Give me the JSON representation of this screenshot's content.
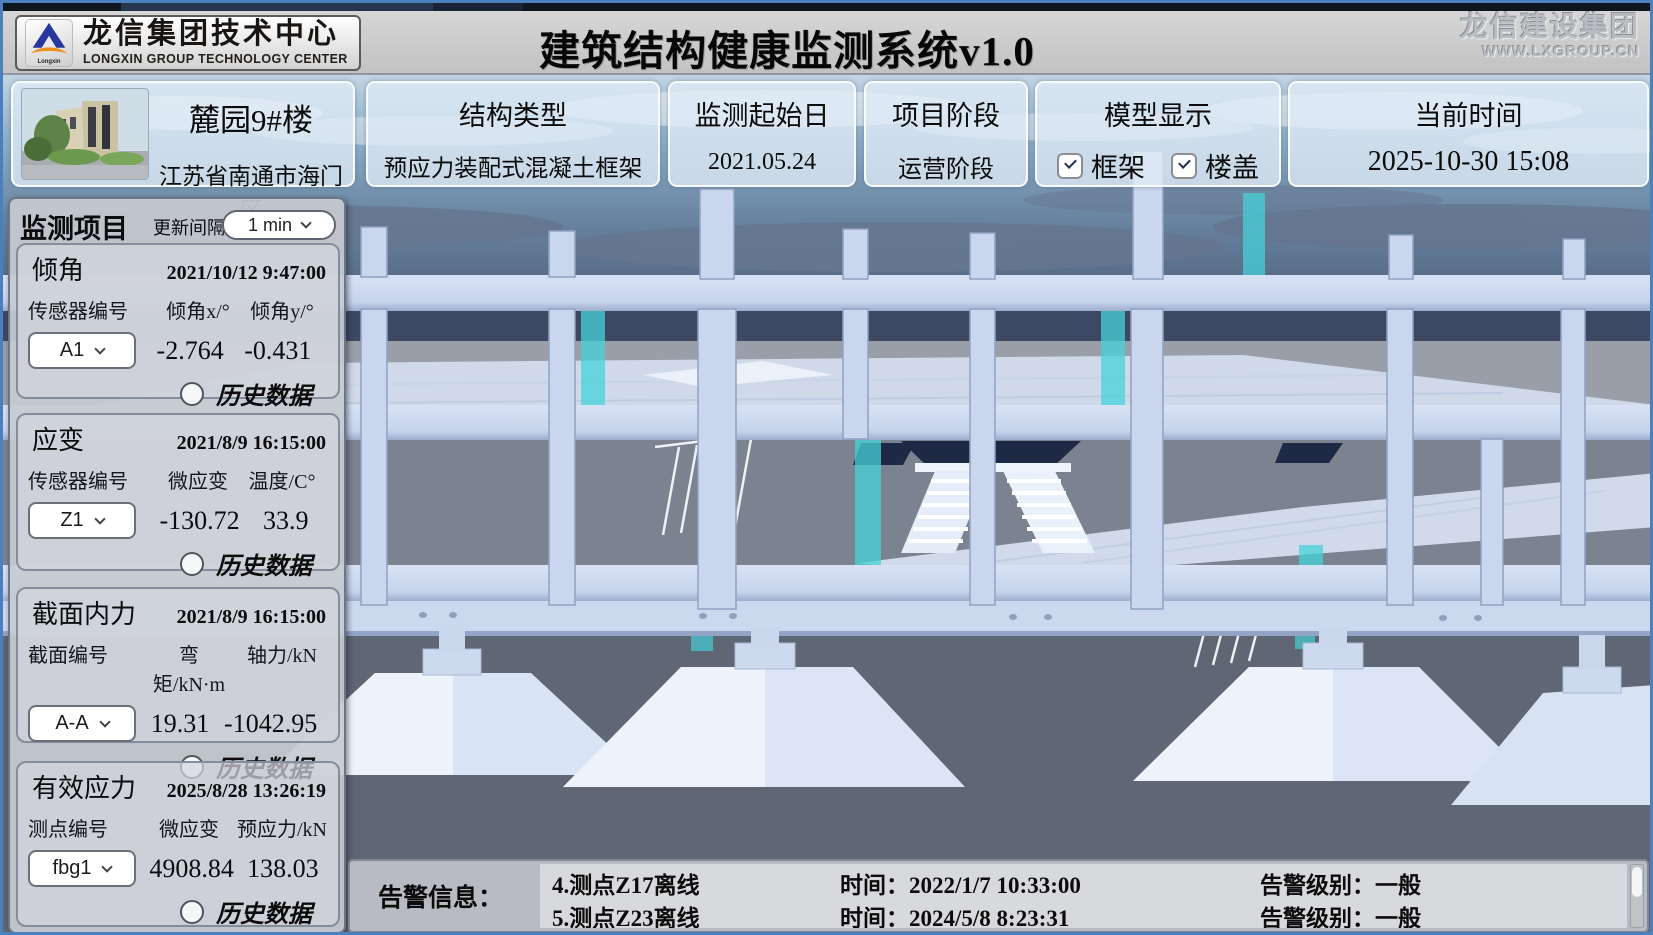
{
  "window": {
    "brand_cn": "龙信集团技术中心",
    "brand_en": "LONGXIN  GROUP TECHNOLOGY CENTER",
    "logo_word": "Longxin",
    "title": "建筑结构健康监测系统v1.0",
    "watermark_line1": "龙信建设集团",
    "watermark_line2": "WWW.LXGROUP.CN"
  },
  "project": {
    "name": "麓园9#楼",
    "location": "江苏省南通市海门区",
    "cards": [
      {
        "label": "结构类型",
        "value": "预应力装配式混凝土框架"
      },
      {
        "label": "监测起始日",
        "value": "2021.05.24"
      },
      {
        "label": "项目阶段",
        "value": "运营阶段"
      }
    ],
    "model_display": {
      "label": "模型显示",
      "options": [
        {
          "label": "框架",
          "checked": true
        },
        {
          "label": "楼盖",
          "checked": true
        }
      ]
    },
    "time_card": {
      "label": "当前时间",
      "value": "2025-10-30 15:08"
    }
  },
  "sidebar": {
    "title": "监测项目",
    "interval_label": "更新间隔",
    "interval_value": "1 min",
    "history_label": "历史数据",
    "panels": [
      {
        "title": "倾角",
        "timestamp": "2021/10/12 9:47:00",
        "col0": "传感器编号",
        "col1": "倾角x/°",
        "col2": "倾角y/°",
        "selected": "A1",
        "val1": "-2.764",
        "val2": "-0.431"
      },
      {
        "title": "应变",
        "timestamp": "2021/8/9 16:15:00",
        "col0": "传感器编号",
        "col1": "微应变",
        "col2": "温度/C°",
        "selected": "Z1",
        "val1": "-130.72",
        "val2": "33.9"
      },
      {
        "title": "截面内力",
        "timestamp": "2021/8/9 16:15:00",
        "col0": "截面编号",
        "col1": "弯矩/kN·m",
        "col2": "轴力/kN",
        "selected": "A-A",
        "val1": "19.31",
        "val2": "-1042.95"
      },
      {
        "title": "有效应力",
        "timestamp": "2025/8/28 13:26:19",
        "col0": "测点编号",
        "col1": "微应变",
        "col2": "预应力/kN",
        "selected": "fbg1",
        "val1": "4908.84",
        "val2": "138.03"
      }
    ]
  },
  "alerts": {
    "label": "告警信息：",
    "items": [
      {
        "name": "4.测点Z17离线",
        "time": "时间：2022/1/7 10:33:00",
        "level": "告警级别：一般"
      },
      {
        "name": "5.测点Z23离线",
        "time": "时间：2024/5/8 8:23:31",
        "level": "告警级别：一般"
      },
      {
        "name": "6.测点Z25离线",
        "time": "时间：2022/1/7 10:33:00",
        "level": "告警级别：一般"
      }
    ]
  },
  "colors": {
    "accent_cyan": "#45d2d8",
    "structure_light": "#cdd9f0",
    "sky_top": "#c0d3e2",
    "horizon_band": "#3d4862",
    "ground_light": "#999ea9",
    "ground_dark": "#5f6674",
    "panel_blue": "#dfeaf6",
    "header_gray": "#c9c9c9",
    "stair_dark": "#1e2a45"
  }
}
